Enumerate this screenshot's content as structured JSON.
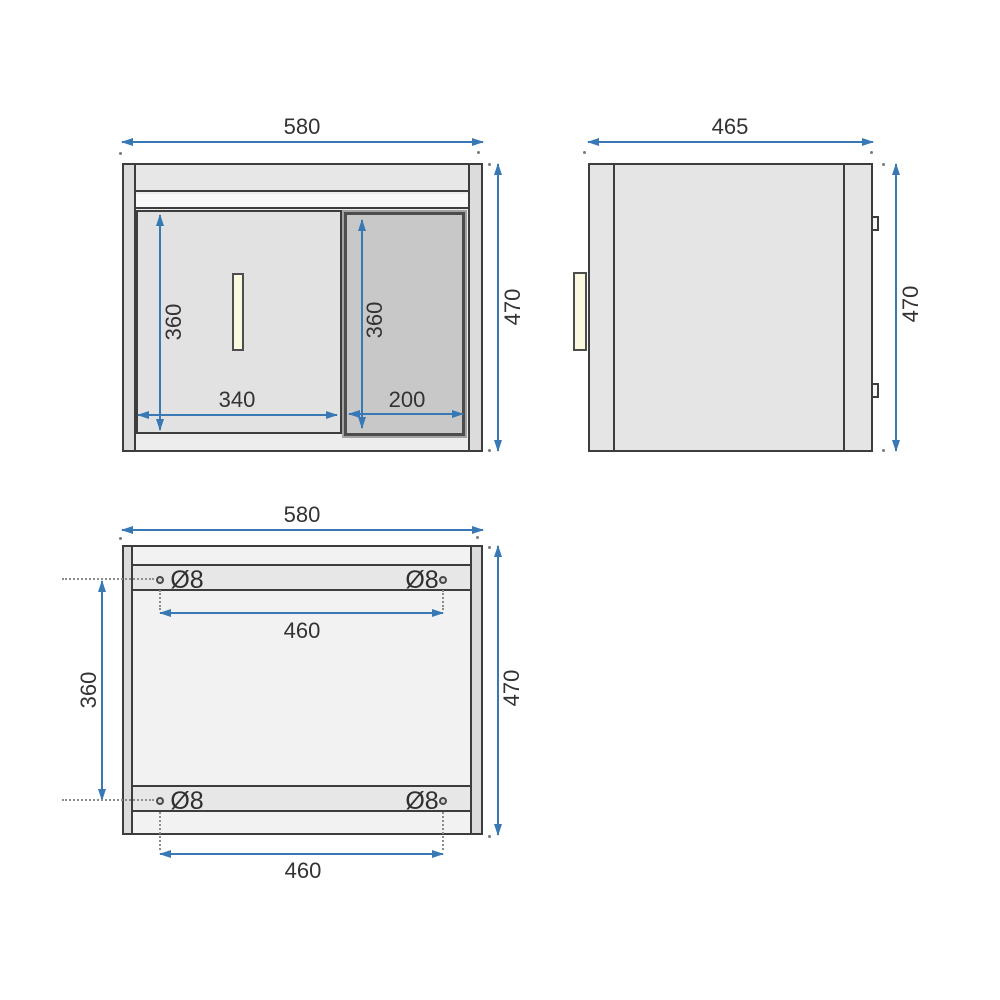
{
  "drawing": {
    "type": "furniture-technical-drawing",
    "units": "mm",
    "colors": {
      "dimension_blue": "#3878b4",
      "outline_dark": "#3d3d3d",
      "handle_cream": "#fbf8e0",
      "door_panel_gray": "#c8c8c8",
      "body_gray": "#ededed"
    }
  },
  "views": {
    "front": {
      "overall_width": "580",
      "overall_height": "470",
      "drawer_height": "360",
      "drawer_width": "340",
      "door_height": "360",
      "door_width": "200"
    },
    "side": {
      "overall_depth": "465",
      "overall_height": "470"
    },
    "back": {
      "overall_width": "580",
      "overall_height": "470",
      "hole_row_spacing": "360",
      "hole_span_top": "460",
      "hole_span_bottom": "460",
      "holes": {
        "top_left": "Ø8",
        "top_right": "Ø8",
        "bottom_left": "Ø8",
        "bottom_right": "Ø8"
      }
    }
  }
}
